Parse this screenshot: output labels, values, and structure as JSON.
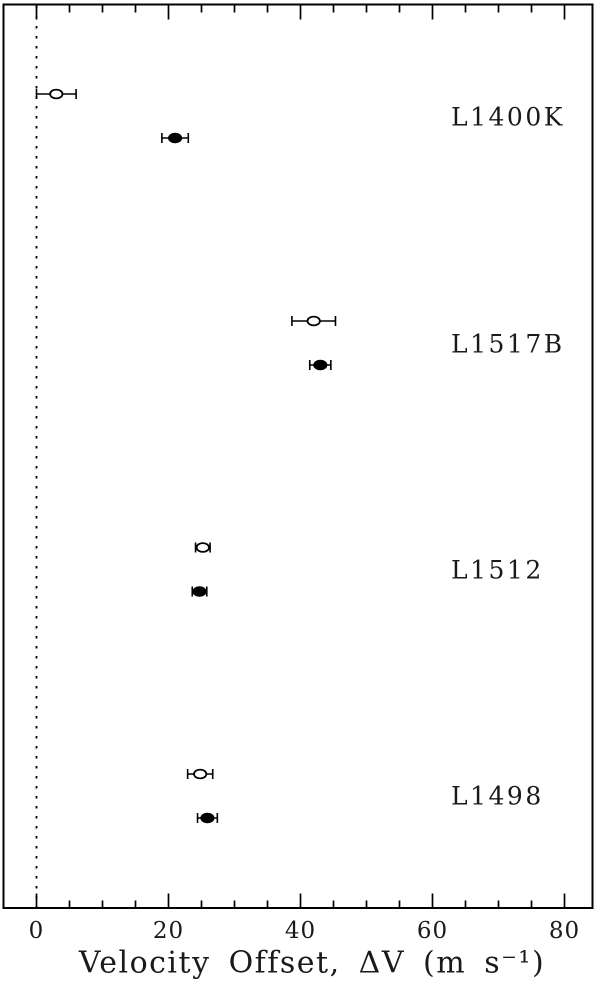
{
  "figure": {
    "background_color": "#ffffff",
    "ink_color": "#000000"
  },
  "chart_data": {
    "type": "scatter",
    "title": "",
    "xlabel": "Velocity Offset, ΔV  (m s⁻¹)",
    "ylabel": "",
    "xlim": [
      -5.1,
      84.4
    ],
    "x_major_ticks": [
      0,
      20,
      40,
      60,
      80
    ],
    "x_major_tick_labels": [
      "0",
      "20",
      "40",
      "60",
      "80"
    ],
    "x_minor_tick_step": 5,
    "grid": false,
    "legend_position": "none",
    "reference_line": {
      "x": 0,
      "style": "dotted"
    },
    "marker_series": [
      {
        "name": "open-circle",
        "marker": "open"
      },
      {
        "name": "filled-circle",
        "marker": "filled"
      }
    ],
    "groups": [
      {
        "label": "L1400K",
        "open": {
          "x": 3.0,
          "xerr": 3.0
        },
        "filled": {
          "x": 21.0,
          "xerr": 2.0
        }
      },
      {
        "label": "L1517B",
        "open": {
          "x": 42.0,
          "xerr": 3.3
        },
        "filled": {
          "x": 43.0,
          "xerr": 1.6
        }
      },
      {
        "label": "L1512",
        "open": {
          "x": 25.2,
          "xerr": 1.1
        },
        "filled": {
          "x": 24.7,
          "xerr": 1.1
        }
      },
      {
        "label": "L1498",
        "open": {
          "x": 24.8,
          "xerr": 1.9
        },
        "filled": {
          "x": 25.9,
          "xerr": 1.5
        }
      }
    ]
  }
}
